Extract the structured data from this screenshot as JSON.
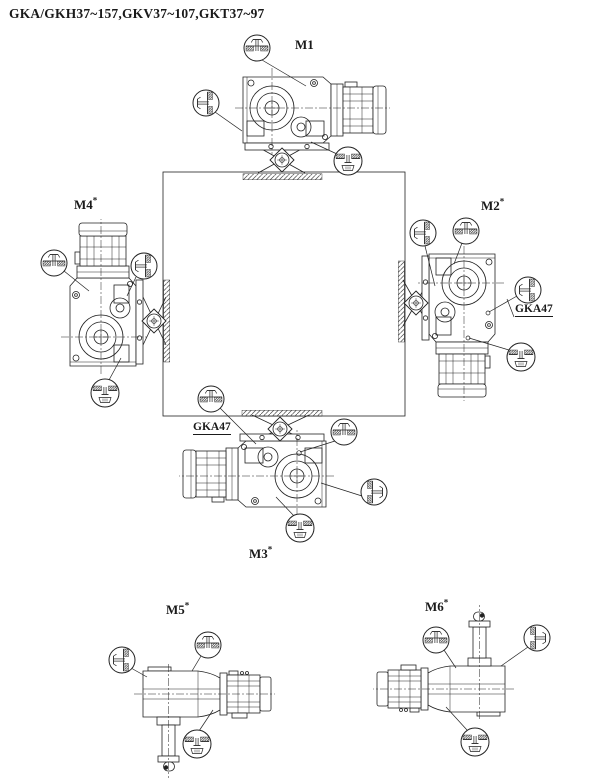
{
  "title": "GKA/GKH37~157,GKV37~107,GKT37~97",
  "positions": {
    "m1": {
      "label": "M1",
      "sup": ""
    },
    "m2": {
      "label": "M2",
      "sup": "*"
    },
    "m3": {
      "label": "M3",
      "sup": "*"
    },
    "m4": {
      "label": "M4",
      "sup": "*"
    },
    "m5": {
      "label": "M5",
      "sup": "*"
    },
    "m6": {
      "label": "M6",
      "sup": "*"
    }
  },
  "annotations": {
    "m2_note": "GKA47",
    "m3_note": "GKA47"
  },
  "icons": {
    "breather": "breather-plug-icon",
    "oil_level": "oil-level-plug-icon",
    "oil_drain": "oil-drain-plug-icon",
    "output_flange": "mounting-flange-icon"
  },
  "colors": {
    "line": "#222222",
    "background": "#ffffff",
    "hatch": "#4a4a4a"
  }
}
